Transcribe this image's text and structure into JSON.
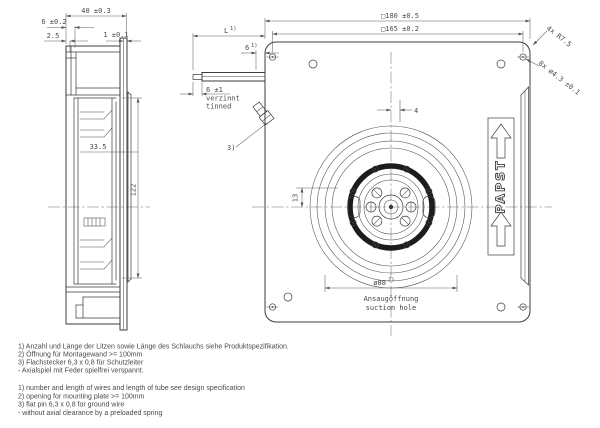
{
  "colors": {
    "ink": "#3c3c3c",
    "background": "#ffffff"
  },
  "side": {
    "width": "40 ±0.3",
    "step": "6 ±0.2",
    "lip": "2.5",
    "flange": "1 ±0.1",
    "depth": "33.5",
    "height": "122"
  },
  "wire": {
    "len": "L",
    "len_sup": "1)",
    "pin": "6",
    "pin_sup": "1)",
    "tin": "6 ±1",
    "tin_de": "verzinnt",
    "tin_en": "tinned",
    "note": "3)"
  },
  "front": {
    "sq_outer": "□180 ±0.5",
    "sq_mount": "□165 ±0.2",
    "radius": "4x R7.5",
    "holes": "8x ø4.3 ±0.1",
    "offset": "4",
    "hub": "13",
    "suction": "ø88",
    "suction_sup": "2)",
    "suction_de": "Ansaugöffnung",
    "suction_en": "suction hole",
    "brand": "PAPST"
  },
  "notes_de": [
    "1) Anzahl und Länge der Litzen sowie Länge des Schlauchs siehe Produktspezifikation.",
    "2) Öffnung für Montagewand >= 100mm",
    "3) Flachstecker 6,3 x 0,8 für Schutzleiter",
    "-  Axialspiel mit Feder spielfrei verspannt."
  ],
  "notes_en": [
    "1) number and length of wires and length of tube see design specification",
    "2) opening for mounting plate >= 100mm",
    "3) flat pin 6,3 x 0,8 for ground wire",
    "-  without axial clearance by a preloaded spring"
  ]
}
